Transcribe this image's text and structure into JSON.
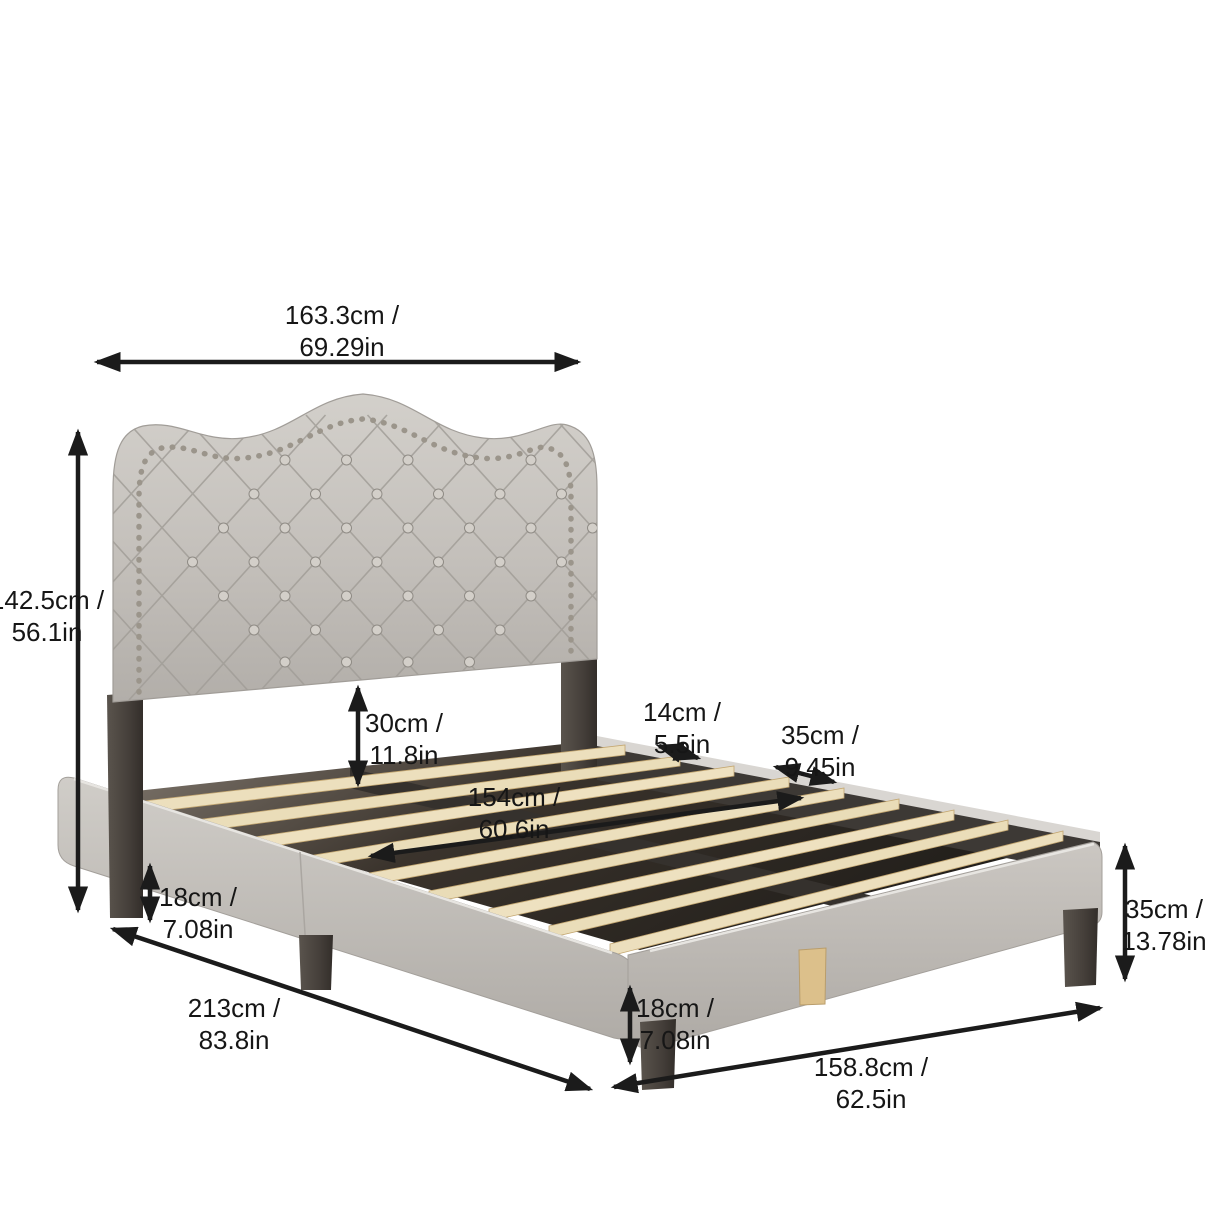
{
  "diagram": {
    "subject": "upholstered bed frame with tufted camelback headboard, nailhead trim and wood slats",
    "view": "three-quarter perspective product dimension drawing",
    "colors": {
      "background": "#ffffff",
      "fabric": "#c7c3be",
      "fabric_shadow": "#b2aea9",
      "leg_wood_dark": "#46413d",
      "slat_wood": "#eaddb9",
      "center_leg_wood": "#dcc08b",
      "nailhead_trim": "#9b958b",
      "arrow": "#1b1b1b"
    },
    "dimensions": [
      {
        "id": "headboard-width",
        "label_cm": "163.3cm /",
        "label_in": "69.29in",
        "location": "top horizontal arrow"
      },
      {
        "id": "headboard-height",
        "label_cm": "142.5cm /",
        "label_in": "56.1in",
        "location": "left vertical arrow"
      },
      {
        "id": "headboard-to-slats",
        "label_cm": "30cm /",
        "label_in": "11.8in",
        "location": "center vertical arrow"
      },
      {
        "id": "slat-gap",
        "label_cm": "14cm /",
        "label_in": "5.5in",
        "location": "upper right small arrow"
      },
      {
        "id": "slat-section-spacing",
        "label_cm": "35cm /",
        "label_in": "9.45in",
        "location": "upper right arrow"
      },
      {
        "id": "slat-length",
        "label_cm": "154cm /",
        "label_in": "60.6in",
        "location": "arrow across slats"
      },
      {
        "id": "side-leg-height",
        "label_cm": "18cm /",
        "label_in": "7.08in",
        "location": "left leg vertical arrow"
      },
      {
        "id": "bed-length",
        "label_cm": "213cm /",
        "label_in": "83.8in",
        "location": "lower left diagonal arrow"
      },
      {
        "id": "foot-leg-height",
        "label_cm": "18cm /",
        "label_in": "7.08in",
        "location": "bottom center vertical arrow"
      },
      {
        "id": "bed-width",
        "label_cm": "158.8cm /",
        "label_in": "62.5in",
        "location": "bottom right diagonal arrow"
      },
      {
        "id": "frame-height",
        "label_cm": "35cm /",
        "label_in": "13.78in",
        "location": "right vertical arrow"
      }
    ]
  }
}
